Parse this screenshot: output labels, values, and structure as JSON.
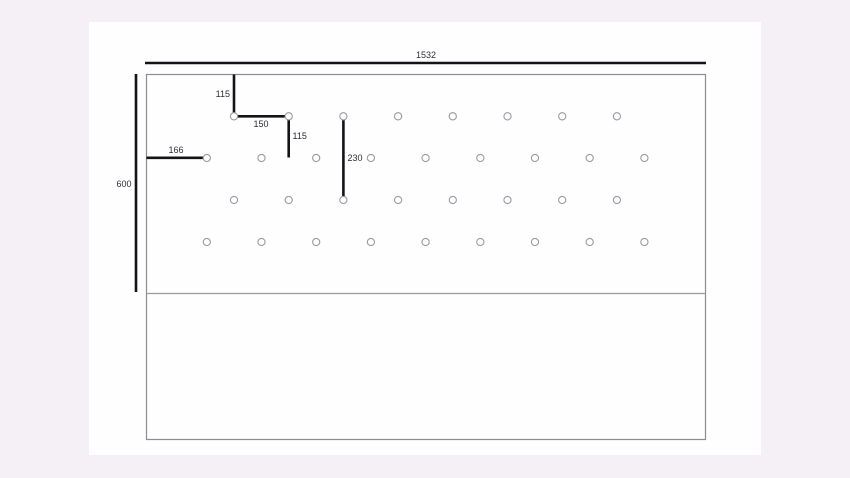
{
  "diagram": {
    "dim_labels": {
      "overall_width": "1532",
      "overall_height": "600",
      "top_offset": "115",
      "hole_pitch": "150",
      "row_offset": "115",
      "left_edge_offset": "166",
      "two_row_spacing": "230"
    },
    "hole_grid": {
      "hole_radius": 3.6,
      "rows": [
        {
          "y": 116.3,
          "xs": [
            234,
            288.7,
            343.4,
            398.1,
            452.8,
            507.5,
            562.2,
            616.9
          ]
        },
        {
          "y": 158.0,
          "xs": [
            206.8,
            261.5,
            316.2,
            370.9,
            425.6,
            480.3,
            535.0,
            589.7,
            644.4
          ]
        },
        {
          "y": 200.0,
          "xs": [
            234,
            288.7,
            343.4,
            398.1,
            452.8,
            507.5,
            562.2,
            616.9
          ]
        },
        {
          "y": 242.0,
          "xs": [
            206.8,
            261.5,
            316.2,
            370.9,
            425.6,
            480.3,
            535.0,
            589.7,
            644.4
          ]
        }
      ]
    },
    "colors": {
      "page_background": "#f4f0f6",
      "canvas_background": "#fefdff",
      "panel_outline": "#8d8d8d",
      "dimension_line": "#141414",
      "hole_stroke": "#9b9b9b",
      "label_text": "#2e2e2e"
    }
  }
}
